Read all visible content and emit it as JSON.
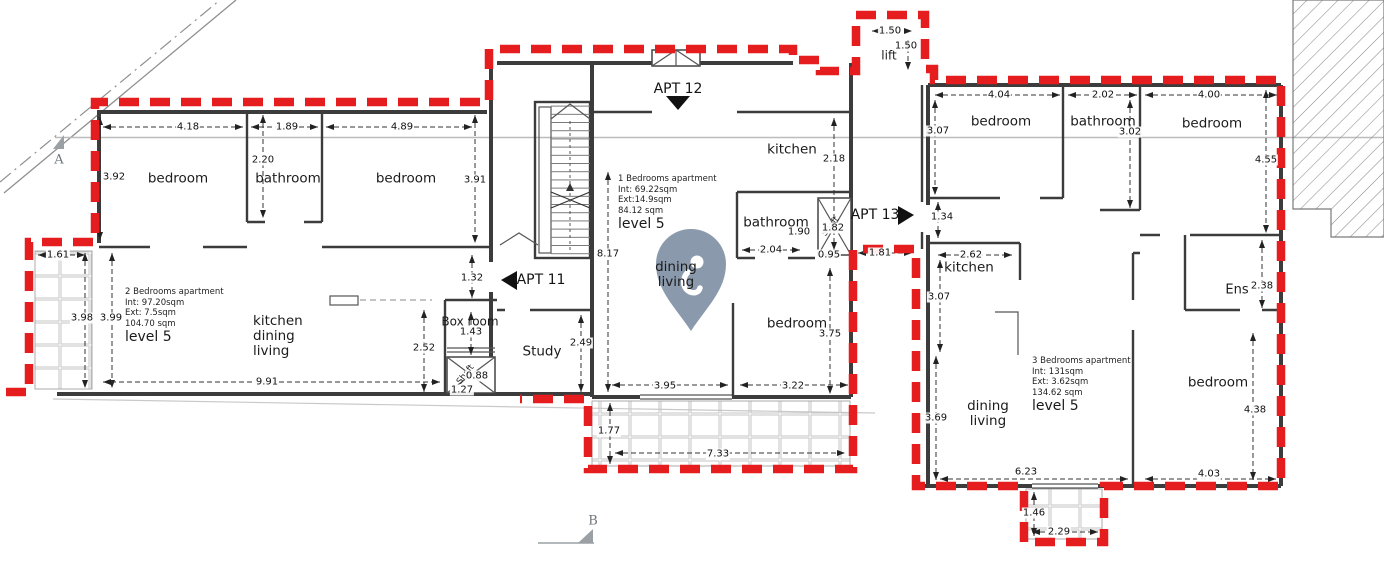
{
  "title": "Level 5 apartment floor plan",
  "colors": {
    "boundary_red": "#e51d1f",
    "pin": "#8a99ab",
    "section_gray": "#9aa0a4",
    "wall": "#3c3c3c",
    "dim_text": "#101010"
  },
  "rooms": [
    {
      "id": "bedroom-left-1",
      "label": "bedroom",
      "x": 178,
      "y": 179
    },
    {
      "id": "bathroom-left",
      "label": "bathroom",
      "x": 288,
      "y": 179
    },
    {
      "id": "bedroom-left-2",
      "label": "bedroom",
      "x": 406,
      "y": 179
    },
    {
      "id": "kitchen-dining-living-left",
      "label": "kitchen\ndining\nliving",
      "x": 253,
      "y": 314,
      "align": "left"
    },
    {
      "id": "box-room",
      "label": "Box room",
      "x": 470,
      "y": 322,
      "size": 12
    },
    {
      "id": "study",
      "label": "Study",
      "x": 542,
      "y": 352
    },
    {
      "id": "shaft-left",
      "label": "Shaft",
      "x": 466,
      "y": 375,
      "size": 8.5,
      "rot": -52
    },
    {
      "id": "kitchen-middle",
      "label": "kitchen",
      "x": 792,
      "y": 150
    },
    {
      "id": "bathroom-middle",
      "label": "bathroom",
      "x": 776,
      "y": 223
    },
    {
      "id": "shaft-middle",
      "label": "Shaft",
      "x": 831,
      "y": 227,
      "size": 8.5,
      "rot": -52
    },
    {
      "id": "dining-living-middle",
      "label": "dining\nliving",
      "x": 676,
      "y": 275
    },
    {
      "id": "bedroom-middle",
      "label": "bedroom",
      "x": 797,
      "y": 324
    },
    {
      "id": "lift",
      "label": "lift",
      "x": 889,
      "y": 56,
      "size": 12
    },
    {
      "id": "bedroom-right-1",
      "label": "bedroom",
      "x": 1001,
      "y": 122
    },
    {
      "id": "bathroom-right",
      "label": "bathroom",
      "x": 1103,
      "y": 122
    },
    {
      "id": "bedroom-right-2",
      "label": "bedroom",
      "x": 1212,
      "y": 124
    },
    {
      "id": "kitchen-right",
      "label": "kitchen",
      "x": 969,
      "y": 268
    },
    {
      "id": "ens-right",
      "label": "Ens",
      "x": 1237,
      "y": 290,
      "size": 13
    },
    {
      "id": "dining-living-right",
      "label": "dining\nliving",
      "x": 988,
      "y": 414
    },
    {
      "id": "bedroom-right-3",
      "label": "bedroom",
      "x": 1218,
      "y": 383
    }
  ],
  "dimensions": [
    {
      "v": "4.18",
      "x": 188,
      "y": 127
    },
    {
      "v": "1.89",
      "x": 287,
      "y": 127
    },
    {
      "v": "4.89",
      "x": 402,
      "y": 127
    },
    {
      "v": "3.92",
      "x": 114,
      "y": 177
    },
    {
      "v": "2.20",
      "x": 263,
      "y": 160
    },
    {
      "v": "3.91",
      "x": 475,
      "y": 180
    },
    {
      "v": "1.61",
      "x": 58,
      "y": 255
    },
    {
      "v": "3.98",
      "x": 82,
      "y": 318
    },
    {
      "v": "3.99",
      "x": 111,
      "y": 318
    },
    {
      "v": "9.91",
      "x": 267,
      "y": 382
    },
    {
      "v": "2.52",
      "x": 424,
      "y": 348
    },
    {
      "v": "1.32",
      "x": 472,
      "y": 278
    },
    {
      "v": "1.43",
      "x": 471,
      "y": 332
    },
    {
      "v": "0.88",
      "x": 477,
      "y": 376
    },
    {
      "v": "1.27",
      "x": 462,
      "y": 390
    },
    {
      "v": "2.49",
      "x": 581,
      "y": 343
    },
    {
      "v": "8.17",
      "x": 608,
      "y": 254
    },
    {
      "v": "2.18",
      "x": 834,
      "y": 159
    },
    {
      "v": "1.90",
      "x": 799,
      "y": 232
    },
    {
      "v": "2.04",
      "x": 771,
      "y": 250
    },
    {
      "v": "1.82",
      "x": 833,
      "y": 228
    },
    {
      "v": "0.95",
      "x": 829,
      "y": 255
    },
    {
      "v": "1.81",
      "x": 880,
      "y": 253
    },
    {
      "v": "3.95",
      "x": 665,
      "y": 386
    },
    {
      "v": "3.22",
      "x": 793,
      "y": 386
    },
    {
      "v": "3.75",
      "x": 830,
      "y": 334
    },
    {
      "v": "1.77",
      "x": 609,
      "y": 431
    },
    {
      "v": "7.33",
      "x": 718,
      "y": 454
    },
    {
      "v": "1.50",
      "x": 890,
      "y": 31
    },
    {
      "v": "1.50",
      "x": 906,
      "y": 46
    },
    {
      "v": "4.04",
      "x": 999,
      "y": 95
    },
    {
      "v": "2.02",
      "x": 1103,
      "y": 95
    },
    {
      "v": "4.00",
      "x": 1209,
      "y": 95
    },
    {
      "v": "3.07",
      "x": 938,
      "y": 131
    },
    {
      "v": "3.02",
      "x": 1130,
      "y": 132
    },
    {
      "v": "4.55",
      "x": 1266,
      "y": 160
    },
    {
      "v": "1.34",
      "x": 942,
      "y": 217
    },
    {
      "v": "2.62",
      "x": 971,
      "y": 255
    },
    {
      "v": "3.07",
      "x": 939,
      "y": 297
    },
    {
      "v": "2.38",
      "x": 1262,
      "y": 286
    },
    {
      "v": "3.69",
      "x": 936,
      "y": 418
    },
    {
      "v": "6.23",
      "x": 1026,
      "y": 472
    },
    {
      "v": "4.03",
      "x": 1209,
      "y": 474
    },
    {
      "v": "4.38",
      "x": 1255,
      "y": 410
    },
    {
      "v": "1.46",
      "x": 1034,
      "y": 513
    },
    {
      "v": "2.29",
      "x": 1059,
      "y": 532
    }
  ],
  "apartments": [
    {
      "id": "apartment-2bed",
      "lines": [
        "2 Bedrooms apartment",
        "Int: 97.20sqm",
        "Ext: 7.5sqm",
        "104.70 sqm"
      ],
      "level": "level 5",
      "x": 125,
      "y": 287
    },
    {
      "id": "apartment-1bed",
      "lines": [
        "1 Bedrooms apartment",
        "Int: 69.22sqm",
        "Ext:14.9sqm",
        "84.12 sqm"
      ],
      "level": "level 5",
      "x": 618,
      "y": 174
    },
    {
      "id": "apartment-3bed",
      "lines": [
        "3 Bedrooms apartment",
        "Int: 131sqm",
        "Ext: 3.62sqm",
        "134.62 sqm"
      ],
      "level": "level 5",
      "x": 1032,
      "y": 356
    }
  ],
  "apt_markers": [
    {
      "id": "apt-11",
      "label": "APT 11",
      "x": 541,
      "y": 280,
      "direction": "left"
    },
    {
      "id": "apt-12",
      "label": "APT 12",
      "x": 678,
      "y": 89,
      "direction": "down"
    },
    {
      "id": "apt-13",
      "label": "APT 13",
      "x": 875,
      "y": 215,
      "direction": "right"
    }
  ],
  "section_markers": [
    {
      "label": "A",
      "x": 59,
      "y": 160
    },
    {
      "label": "B",
      "x": 593,
      "y": 521
    }
  ]
}
